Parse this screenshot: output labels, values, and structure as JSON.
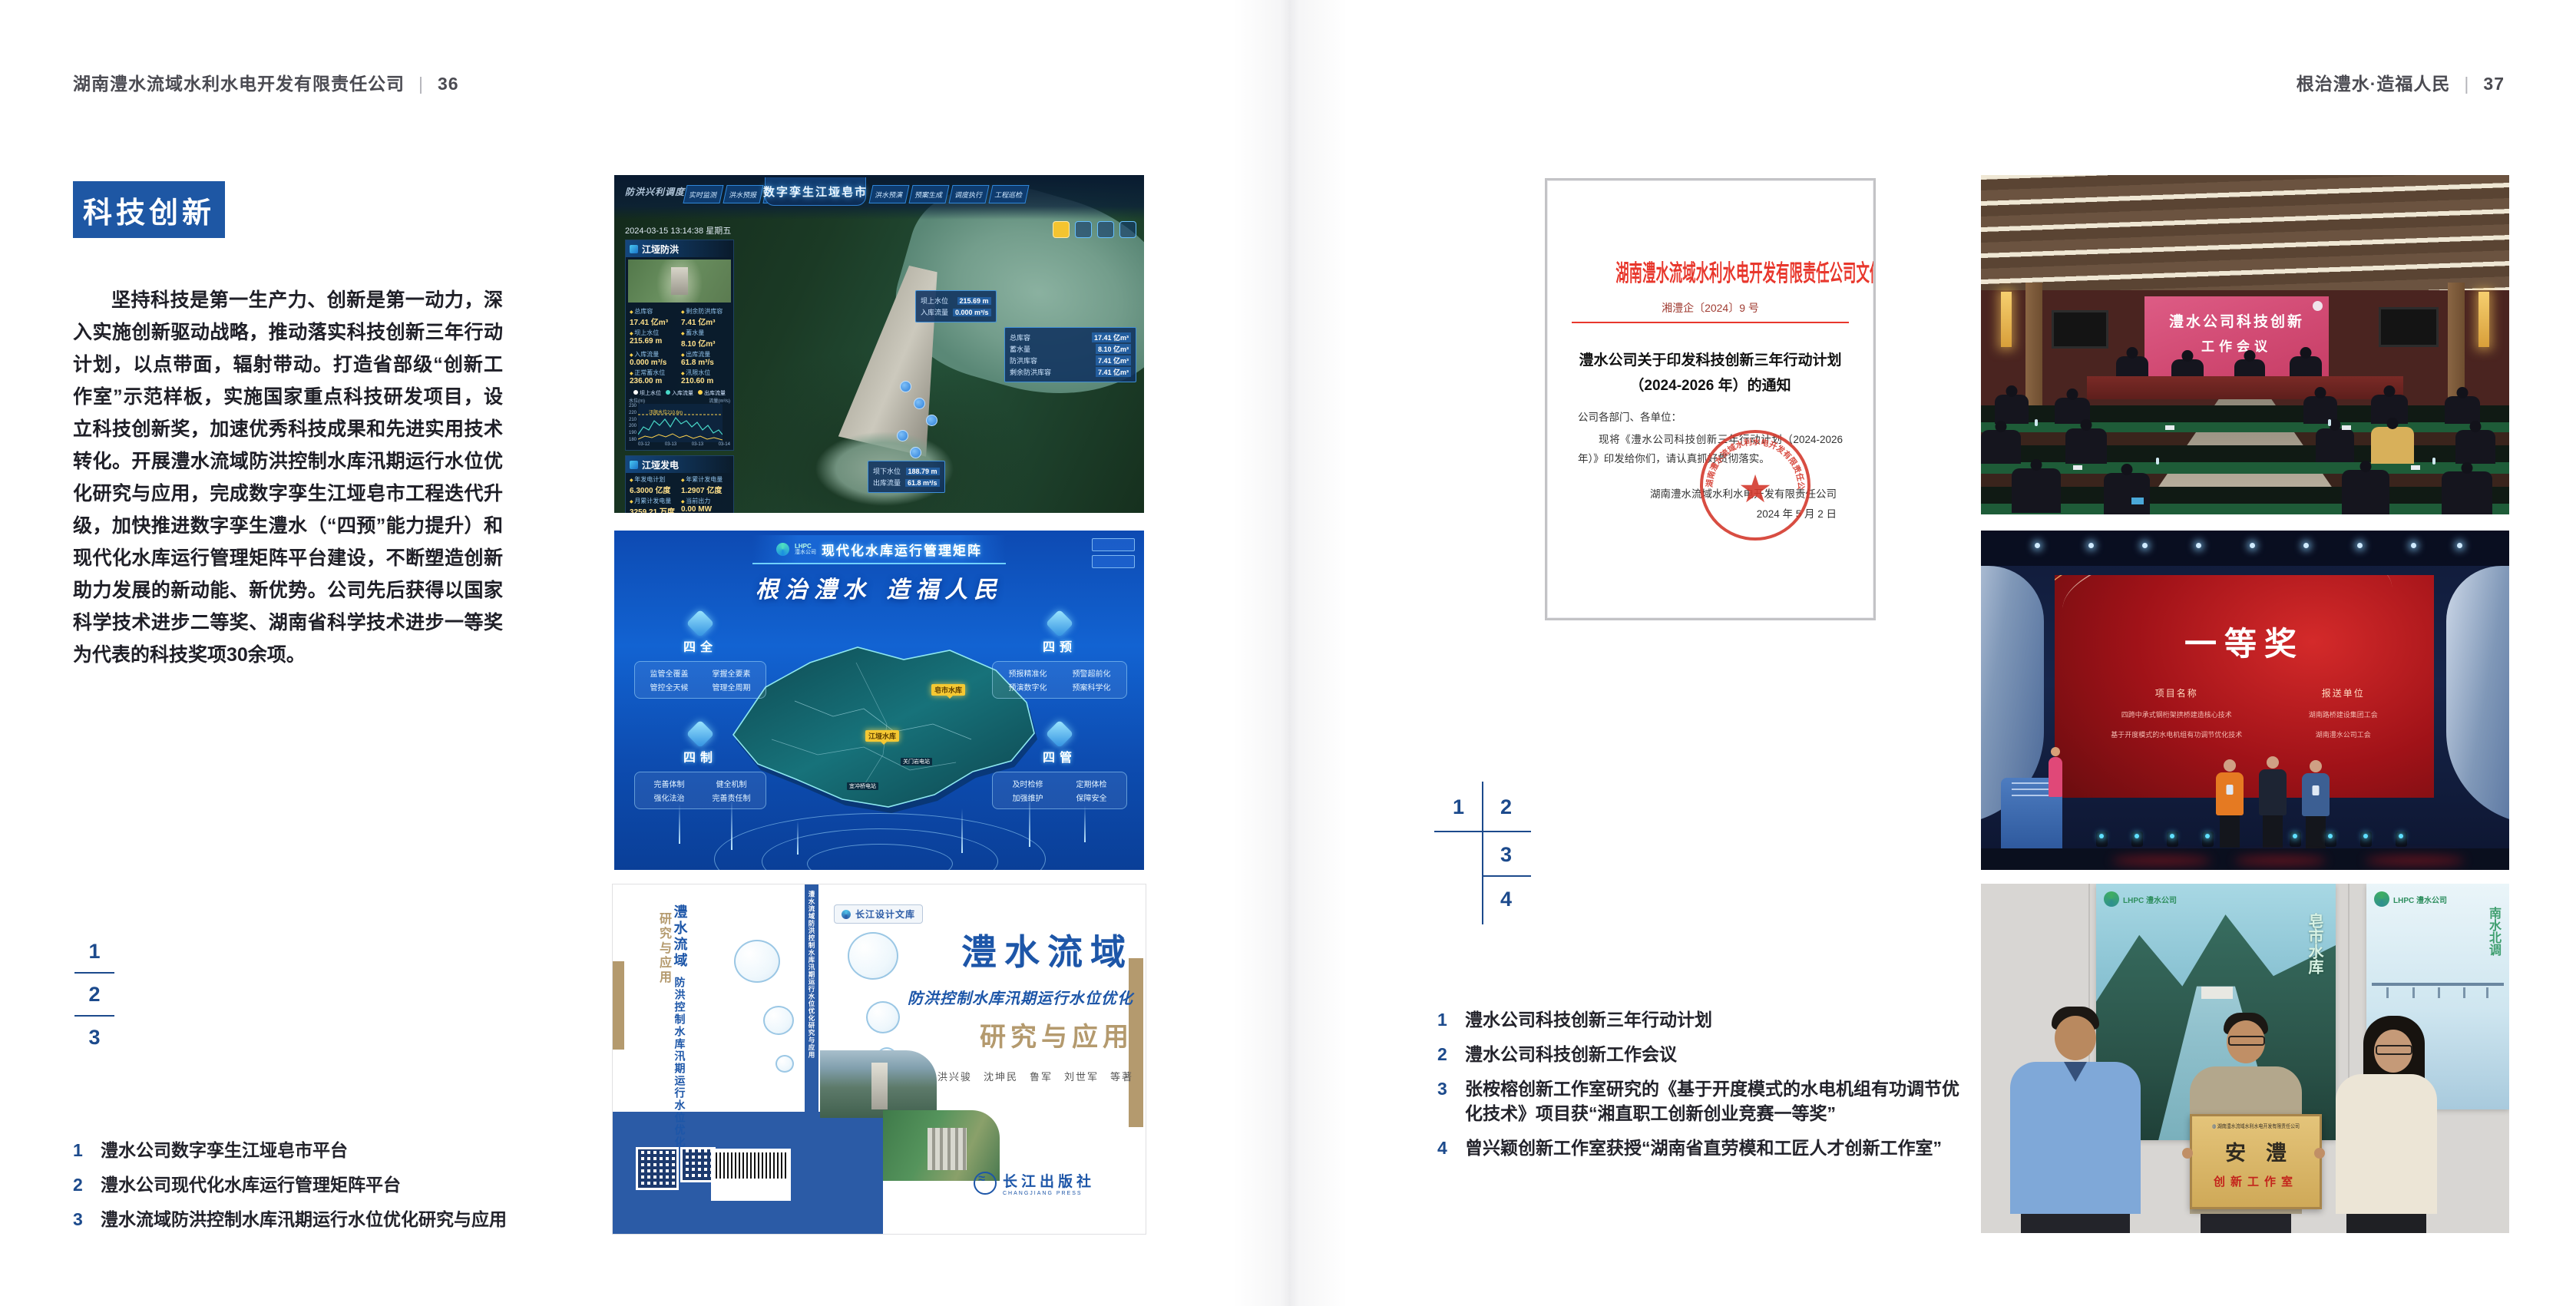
{
  "page_left": {
    "header": {
      "company": "湖南澧水流域水利水电开发有限责任公司",
      "divider": "|",
      "page_number": "36"
    },
    "section_badge": "科技创新",
    "body_paragraph": "坚持科技是第一生产力、创新是第一动力，深入实施创新驱动战略，推动落实科技创新三年行动计划，以点带面，辐射带动。打造省部级“创新工作室”示范样板，实施国家重点科技研发项目，设立科技创新奖，加速优秀科技成果和先进实用技术转化。开展澧水流域防洪控制水库汛期运行水位优化研究与应用，完成数字孪生江垭皂市工程迭代升级，加快推进数字孪生澧水（“四预”能力提升）和现代化水库运行管理矩阵平台建设，不断塑造创新助力发展的新动能、新优势。公司先后获得以国家科学技术进步二等奖、湖南省科学技术进步一等奖为代表的科技奖项30余项。",
    "figure_index": [
      "1",
      "2",
      "3"
    ],
    "captions": [
      {
        "num": "1",
        "text": "澧水公司数字孪生江垭皂市平台"
      },
      {
        "num": "2",
        "text": "澧水公司现代化水库运行管理矩阵平台"
      },
      {
        "num": "3",
        "text": "澧水流域防洪控制水库汛期运行水位优化研究与应用"
      }
    ]
  },
  "page_right": {
    "header": {
      "slogan": "根治澧水·造福人民",
      "divider": "|",
      "page_number": "37"
    },
    "figure_index": [
      "1",
      "2",
      "3",
      "4"
    ],
    "captions": [
      {
        "num": "1",
        "text": "澧水公司科技创新三年行动计划"
      },
      {
        "num": "2",
        "text": "澧水公司科技创新工作会议"
      },
      {
        "num": "3",
        "text": "张桉榕创新工作室研究的《基于开度模式的水电机组有功调节优化技术》项目获“湘直职工创新创业竞赛一等奖”"
      },
      {
        "num": "4",
        "text": "曾兴颖创新工作室获授“湖南省直劳模和工匠人才创新工作室”"
      }
    ]
  },
  "figures": {
    "dashboard": {
      "title": "数字孪生江垭皂市",
      "corner_label": "防洪兴利调度",
      "tabs_left": [
        "实时监测",
        "洪水预报",
        "防洪预警"
      ],
      "tabs_right": [
        "洪水预演",
        "预案生成",
        "调度执行",
        "工程巡检"
      ],
      "datetime": "2024-03-15 13:14:38 星期五",
      "panel_flood": {
        "title": "江垭防洪",
        "stats": [
          [
            "总库容",
            "17.41 亿m³"
          ],
          [
            "剩余防洪库容",
            "7.41 亿m³"
          ],
          [
            "坝上水位",
            "215.69 m"
          ],
          [
            "蓄水量",
            "8.10 亿m³"
          ],
          [
            "入库流量",
            "0.000 m³/s"
          ],
          [
            "出库流量",
            "61.8 m³/s"
          ],
          [
            "正常蓄水位",
            "236.00 m"
          ],
          [
            "汛限水位",
            "210.60 m"
          ]
        ],
        "chart": {
          "legend": [
            "坝上水位",
            "入库流量",
            "出库流量"
          ],
          "unit_left": "水位(m)",
          "unit_right": "流量(m³/s)",
          "annotation": "汛限水位210.6m",
          "y_ticks": [
            "230",
            "220",
            "210",
            "200",
            "190",
            "180"
          ],
          "x_ticks": [
            "03-12",
            "03-13",
            "03-13",
            "03-14"
          ]
        }
      },
      "panel_power": {
        "title": "江垭发电",
        "stats": [
          [
            "年发电计划",
            "6.3000 亿度"
          ],
          [
            "年累计发电量",
            "1.2907 亿度"
          ],
          [
            "月累计发电量",
            "3259.21 万度"
          ],
          [
            "当前出力",
            "0.00 MW"
          ],
          [
            "发电流量",
            "0.00 m³/s"
          ],
          [
            "弃水流量",
            "0.00 m³/s"
          ]
        ],
        "gauges": [
          {
            "value": "0.00",
            "label": "1#机组"
          },
          {
            "value": "100.58",
            "label": "2#机组"
          },
          {
            "value": "0.00",
            "label": "3#机组"
          }
        ]
      },
      "tooltip_upstream": [
        [
          "坝上水位",
          "215.69 m"
        ],
        [
          "入库流量",
          "0.000 m³/s"
        ]
      ],
      "tooltip_capacity": [
        [
          "总库容",
          "17.41 亿m³"
        ],
        [
          "蓄水量",
          "8.10 亿m³"
        ],
        [
          "防洪库容",
          "7.41 亿m³"
        ],
        [
          "剩余防洪库容",
          "7.41 亿m³"
        ]
      ],
      "tooltip_downstream": [
        [
          "坝下水位",
          "188.79 m"
        ],
        [
          "出库流量",
          "61.8 m³/s"
        ]
      ]
    },
    "matrix": {
      "logo_abbr": "LHPC",
      "logo_name": "澧水公司",
      "title": "现代化水库运行管理矩阵",
      "slogan": "根治澧水 造福人民",
      "groups": [
        {
          "title": "四全",
          "items": [
            "监管全覆盖",
            "掌握全要素",
            "管控全天候",
            "管理全周期"
          ]
        },
        {
          "title": "四预",
          "items": [
            "预报精准化",
            "预警超前化",
            "预演数字化",
            "预案科学化"
          ]
        },
        {
          "title": "四制",
          "items": [
            "完善体制",
            "健全机制",
            "强化法治",
            "完善责任制"
          ]
        },
        {
          "title": "四管",
          "items": [
            "及时检修",
            "定期体检",
            "加强维护",
            "保障安全"
          ]
        }
      ],
      "labels_major": [
        "皂市水库",
        "江垭水库"
      ],
      "labels_minor": [
        "关门岩电站",
        "宜冲桥电站"
      ]
    },
    "book": {
      "series": "长江设计文库",
      "title_main": "澧水流域",
      "title_sub": "防洪控制水库汛期运行水位优化",
      "title_tail": "研究与应用",
      "authors": "洪兴骏　沈坤民　鲁军　刘世军　等著",
      "spine_title": "澧水流域防洪控制水库汛期运行水位优化研究与应用",
      "publisher": "长江出版社",
      "publisher_en": "CHANGJIANG PRESS"
    },
    "document": {
      "header": "湖南澧水流域水利水电开发有限责任公司文件",
      "doc_number": "湘澧企〔2024〕9 号",
      "title_line1": "澧水公司关于印发科技创新三年行动计划",
      "title_line2": "（2024-2026 年）的通知",
      "salutation": "公司各部门、各单位：",
      "body": "现将《澧水公司科技创新三年行动计划（2024-2026 年）》印发给你们，请认真抓好贯彻落实。",
      "signer": "湖南澧水流域水利水电开发有限责任公司",
      "date": "2024 年 5 月 2 日",
      "seal_text": "湖南澧水流域水利水电开发有限责任公司"
    },
    "meeting": {
      "screen_line1": "澧水公司科技创新",
      "screen_line2": "工作会议"
    },
    "award": {
      "screen_title": "一等奖",
      "col_project_header": "项目名称",
      "col_project_items": [
        "四跨中承式钢桁架拱桥建造核心技术",
        "基于开度模式的水电机组有功调节优化技术"
      ],
      "col_unit_header": "报送单位",
      "col_unit_items": [
        "湖南路桥建设集团工会",
        "湖南澧水公司工会"
      ]
    },
    "workshop": {
      "logo_text": "LHPC 澧水公司",
      "plaque_org": "湖南澧水流域水利水电开发有限责任公司",
      "plaque_name": "安澧",
      "plaque_sub": "创新工作室",
      "poster_left_text": "皂市水库",
      "poster_right_text": "南水北调"
    }
  },
  "colors": {
    "accent_blue": "#1e57a4",
    "index_blue": "#1c4a8c",
    "doc_red": "#e8372c",
    "band_blue": "#2b5ba6"
  }
}
